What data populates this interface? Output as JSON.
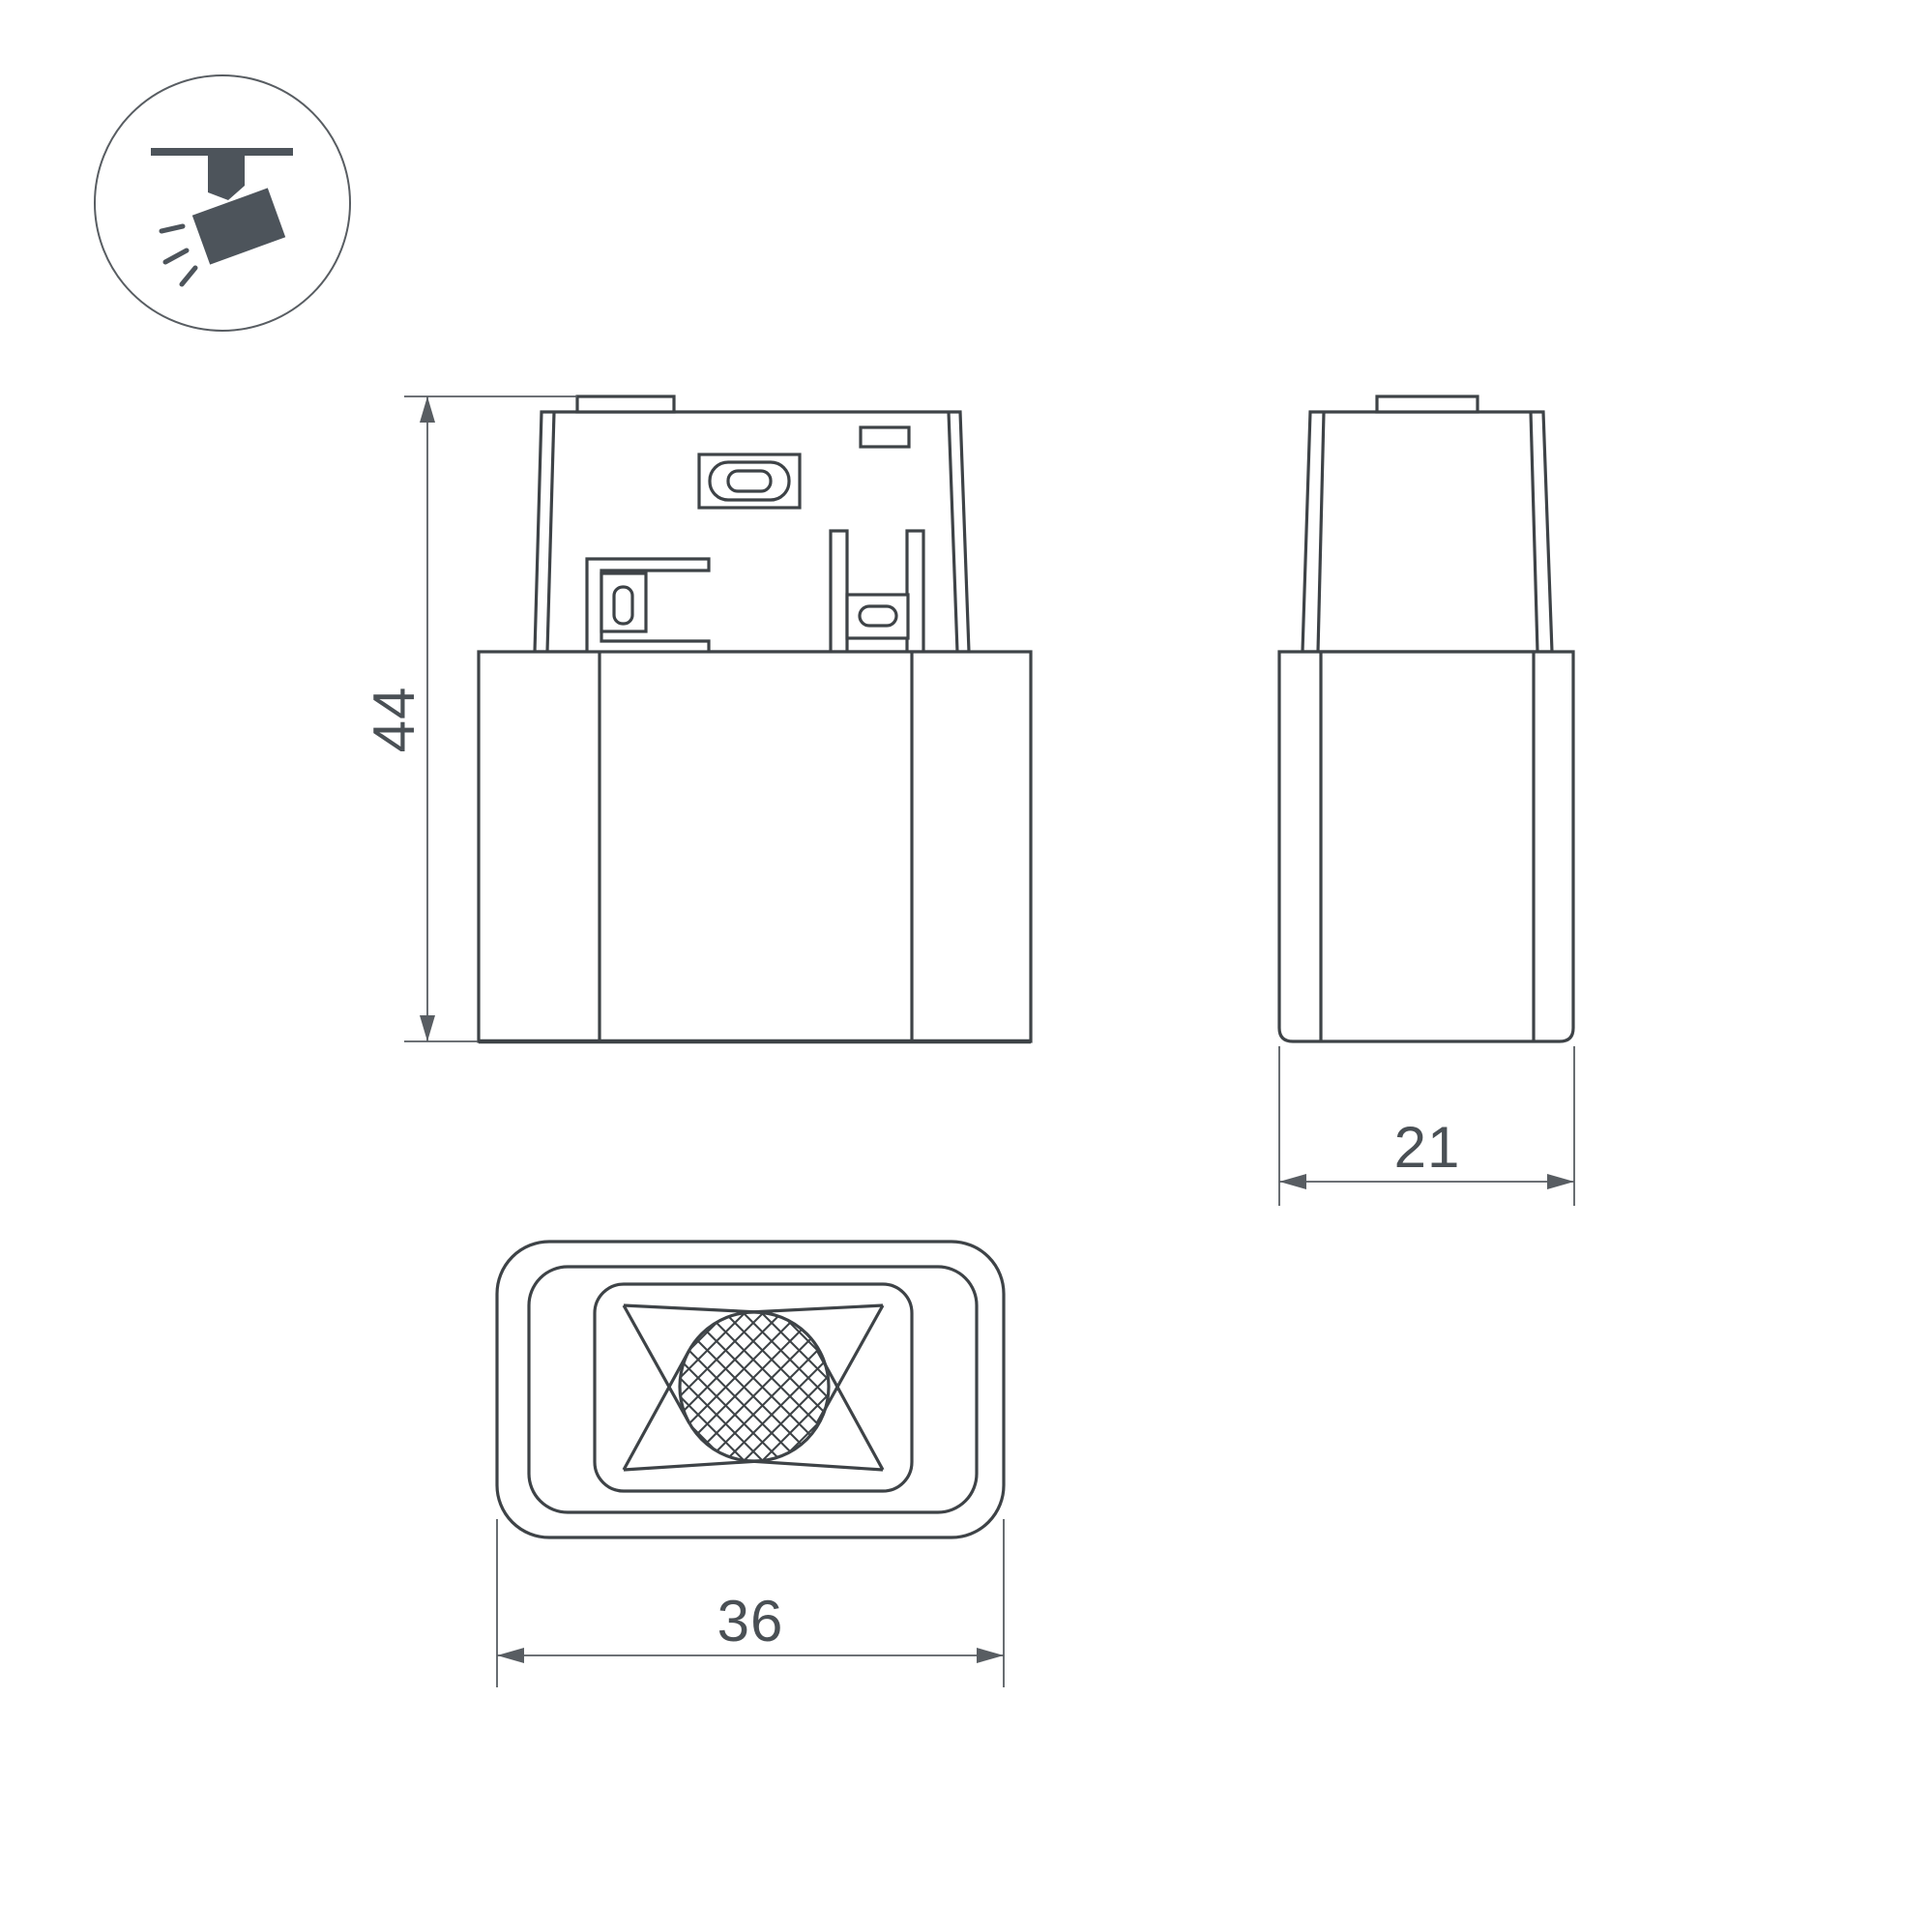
{
  "palette": {
    "background": "#ffffff",
    "line": "#3e4347",
    "dim": "#585d62",
    "text": "#4a5055",
    "icon": "#4d545b"
  },
  "dimensions": {
    "height_mm": "44",
    "depth_mm": "21",
    "width_mm": "36"
  }
}
